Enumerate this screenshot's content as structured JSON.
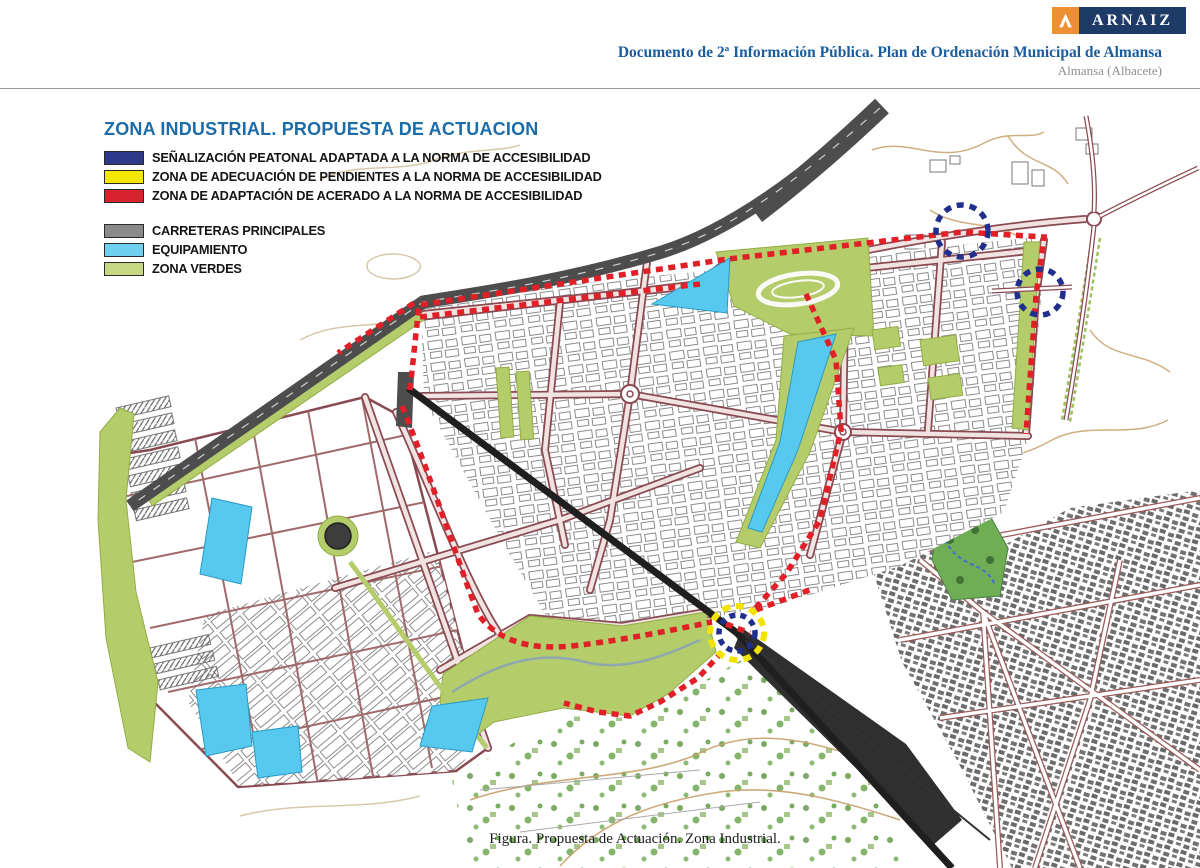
{
  "header": {
    "logo": {
      "text": "ARNAIZ",
      "icon": "arnaiz-a-icon",
      "orange": "#ee8f33",
      "navy": "#1e3a66"
    },
    "doc_title": "Documento de 2ª Información Pública. Plan de Ordenación Municipal de Almansa",
    "doc_title_color": "#1a5c9e",
    "subtitle": "Almansa (Albacete)",
    "subtitle_color": "#8a8f94"
  },
  "map": {
    "title": "ZONA INDUSTRIAL. PROPUESTA DE ACTUACION",
    "title_color": "#1b6ca8",
    "legend_primary": [
      {
        "label": "SEÑALIZACIÓN PEATONAL ADAPTADA A LA NORMA DE ACCESIBILIDAD",
        "color": "#2d3a8c"
      },
      {
        "label": "ZONA DE ADECUACIÓN DE PENDIENTES A LA NORMA DE ACCESIBILIDAD",
        "color": "#f3e600"
      },
      {
        "label": "ZONA DE ADAPTACIÓN DE ACERADO A LA NORMA DE ACCESIBILIDAD",
        "color": "#d8232e"
      }
    ],
    "legend_secondary": [
      {
        "label": "CARRETERAS PRINCIPALES",
        "color": "#8a8a8a"
      },
      {
        "label": "EQUIPAMIENTO",
        "color": "#6fd0f0"
      },
      {
        "label": "ZONA VERDES",
        "color": "#c6d883"
      }
    ],
    "map_colors": {
      "actuation_red": "#e01f26",
      "pedestrian_blue": "#202e8c",
      "slope_yellow": "#f4e300",
      "green_zone": "#b5cc6b",
      "equipment_cyan": "#57c8ee",
      "main_road_gray": "#4d4d4d"
    }
  },
  "caption": "Figura. Propuesta de Actuación. Zona Industrial."
}
